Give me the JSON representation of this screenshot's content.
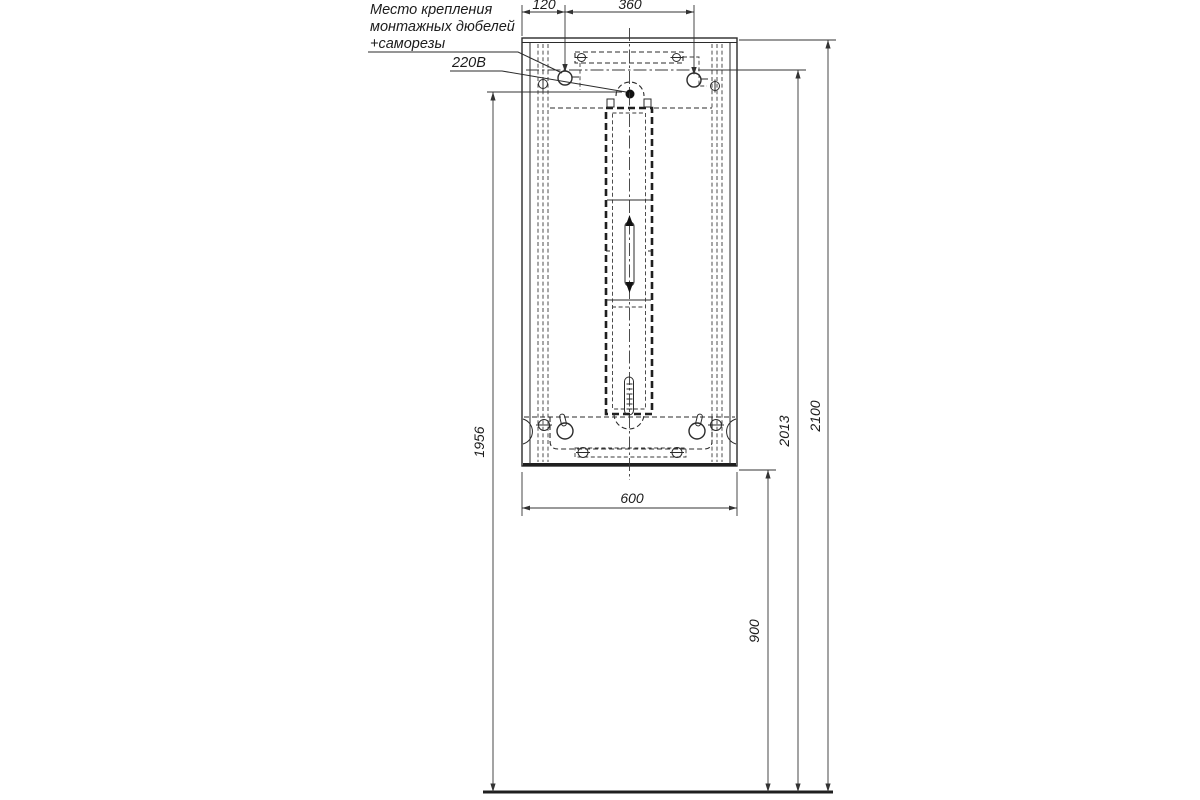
{
  "labels": {
    "mounting_note_line1": "Место крепления",
    "mounting_note_line2": "монтажных дюбелей",
    "mounting_note_line3": "+саморезы",
    "power": "220В"
  },
  "dimensions": {
    "top_offset": "120",
    "dowel_spacing": "360",
    "cabinet_width": "600",
    "outlet_height": "1956",
    "dowel_height": "2013",
    "total_height": "2100",
    "bottom_height": "900"
  }
}
